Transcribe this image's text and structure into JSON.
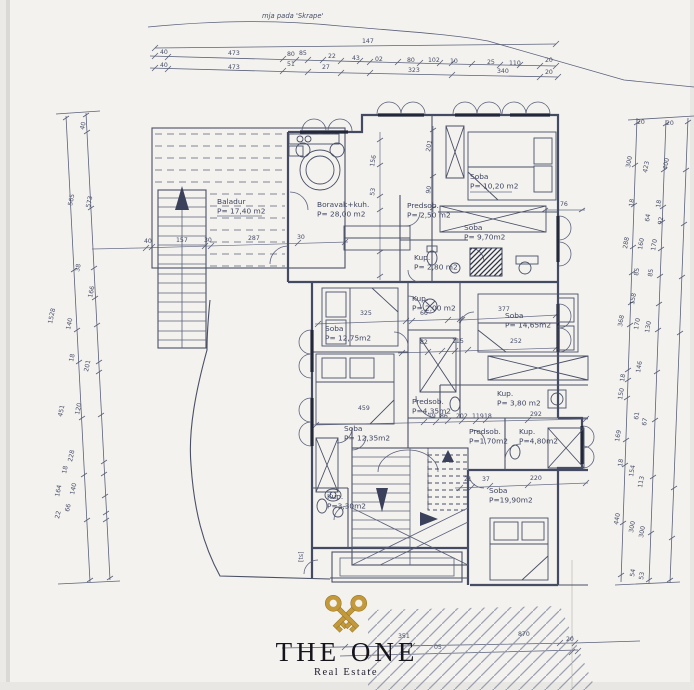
{
  "meta": {
    "paper_color": "#f3f2ef",
    "ink_color": "#454b63",
    "gold_color": "#c3993b",
    "logo_text_color": "#15141b"
  },
  "site": {
    "contour_label": "mja pada 'Skrape'"
  },
  "logo": {
    "title": "THE ONE",
    "subtitle": "Real Estate"
  },
  "rooms": [
    {
      "name": "Baladur",
      "area": "P= 17,40 m2",
      "x": 217,
      "y": 204
    },
    {
      "name": "Boravak+kuh.",
      "area": "P= 28,00 m2",
      "x": 317,
      "y": 207
    },
    {
      "name": "Soba",
      "area": "P= 10,20 m2",
      "x": 470,
      "y": 179
    },
    {
      "name": "Predsob.",
      "area": "P= 2,50 m2",
      "x": 407,
      "y": 208
    },
    {
      "name": "Soba",
      "area": "P= 9,70m2",
      "x": 464,
      "y": 230
    },
    {
      "name": "Kup.",
      "area": "P= 2,80 m2",
      "x": 414,
      "y": 260
    },
    {
      "name": "Soba",
      "area": "P= 12,75m2",
      "x": 325,
      "y": 331
    },
    {
      "name": "Kup.",
      "area": "P= 2,00 m2",
      "x": 412,
      "y": 301
    },
    {
      "name": "Soba",
      "area": "P= 14,65m2",
      "x": 505,
      "y": 318
    },
    {
      "name": "Predsob.",
      "area": "P=4,35m2",
      "x": 412,
      "y": 404
    },
    {
      "name": "Kup.",
      "area": "P= 3,80 m2",
      "x": 497,
      "y": 396
    },
    {
      "name": "Soba",
      "area": "P= 12,35m2",
      "x": 344,
      "y": 431
    },
    {
      "name": "Predsob.",
      "area": "P=1,70m2",
      "x": 469,
      "y": 434
    },
    {
      "name": "Kup.",
      "area": "P=4,80m2",
      "x": 519,
      "y": 434
    },
    {
      "name": "Soba",
      "area": "P=19,90m2",
      "x": 489,
      "y": 493
    },
    {
      "name": "Kup.",
      "area": "P=3,30m2",
      "x": 327,
      "y": 499
    }
  ],
  "dimension_labels": [
    {
      "t": "147",
      "x": 362,
      "y": 43
    },
    {
      "t": "40",
      "x": 160,
      "y": 54
    },
    {
      "t": "473",
      "x": 228,
      "y": 55
    },
    {
      "t": "80",
      "x": 287,
      "y": 56
    },
    {
      "t": "85",
      "x": 299,
      "y": 55
    },
    {
      "t": "22",
      "x": 328,
      "y": 58
    },
    {
      "t": "43",
      "x": 352,
      "y": 60
    },
    {
      "t": "02",
      "x": 375,
      "y": 61
    },
    {
      "t": "80",
      "x": 407,
      "y": 62
    },
    {
      "t": "102",
      "x": 428,
      "y": 62
    },
    {
      "t": "10",
      "x": 450,
      "y": 63
    },
    {
      "t": "25",
      "x": 487,
      "y": 64
    },
    {
      "t": "110",
      "x": 509,
      "y": 65
    },
    {
      "t": "20",
      "x": 545,
      "y": 62
    },
    {
      "t": "40",
      "x": 160,
      "y": 67
    },
    {
      "t": "473",
      "x": 228,
      "y": 69
    },
    {
      "t": "51",
      "x": 287,
      "y": 66
    },
    {
      "t": "27",
      "x": 322,
      "y": 69
    },
    {
      "t": "323",
      "x": 408,
      "y": 72
    },
    {
      "t": "340",
      "x": 497,
      "y": 73
    },
    {
      "t": "20",
      "x": 545,
      "y": 74
    },
    {
      "t": "40",
      "x": 144,
      "y": 243
    },
    {
      "t": "157",
      "x": 176,
      "y": 242
    },
    {
      "t": "30",
      "x": 204,
      "y": 242
    },
    {
      "t": "287",
      "x": 248,
      "y": 240
    },
    {
      "t": "30",
      "x": 297,
      "y": 239
    },
    {
      "t": "156",
      "x": 374,
      "y": 167,
      "r": -80
    },
    {
      "t": "53",
      "x": 374,
      "y": 196,
      "r": -80
    },
    {
      "t": "201",
      "x": 430,
      "y": 152,
      "r": -80
    },
    {
      "t": "90",
      "x": 430,
      "y": 194,
      "r": -80
    },
    {
      "t": "76",
      "x": 560,
      "y": 206
    },
    {
      "t": "325",
      "x": 360,
      "y": 315
    },
    {
      "t": "66",
      "x": 420,
      "y": 315
    },
    {
      "t": "377",
      "x": 498,
      "y": 311
    },
    {
      "t": "82",
      "x": 420,
      "y": 344
    },
    {
      "t": "115",
      "x": 452,
      "y": 343
    },
    {
      "t": "252",
      "x": 510,
      "y": 343
    },
    {
      "t": "459",
      "x": 358,
      "y": 410
    },
    {
      "t": "19",
      "x": 428,
      "y": 418
    },
    {
      "t": "86",
      "x": 440,
      "y": 418
    },
    {
      "t": "202",
      "x": 456,
      "y": 418
    },
    {
      "t": "119",
      "x": 472,
      "y": 418
    },
    {
      "t": "18",
      "x": 484,
      "y": 418
    },
    {
      "t": "292",
      "x": 530,
      "y": 416
    },
    {
      "t": "21",
      "x": 464,
      "y": 481
    },
    {
      "t": "37",
      "x": 482,
      "y": 481
    },
    {
      "t": "220",
      "x": 530,
      "y": 480
    },
    {
      "t": "40",
      "x": 84,
      "y": 130,
      "r": -78
    },
    {
      "t": "565",
      "x": 72,
      "y": 206,
      "r": -78
    },
    {
      "t": "573",
      "x": 90,
      "y": 208,
      "r": -78
    },
    {
      "t": "38",
      "x": 79,
      "y": 272,
      "r": -78
    },
    {
      "t": "166",
      "x": 92,
      "y": 298,
      "r": -78
    },
    {
      "t": "1528",
      "x": 52,
      "y": 324,
      "r": -78
    },
    {
      "t": "140",
      "x": 70,
      "y": 330,
      "r": -78
    },
    {
      "t": "18",
      "x": 73,
      "y": 362,
      "r": -78
    },
    {
      "t": "201",
      "x": 88,
      "y": 372,
      "r": -78
    },
    {
      "t": "451",
      "x": 62,
      "y": 417,
      "r": -78
    },
    {
      "t": "120",
      "x": 79,
      "y": 415,
      "r": -78
    },
    {
      "t": "228",
      "x": 72,
      "y": 462,
      "r": -78
    },
    {
      "t": "18",
      "x": 66,
      "y": 474,
      "r": -78
    },
    {
      "t": "164",
      "x": 59,
      "y": 497,
      "r": -78
    },
    {
      "t": "140",
      "x": 74,
      "y": 495,
      "r": -78
    },
    {
      "t": "66",
      "x": 69,
      "y": 512,
      "r": -78
    },
    {
      "t": "22",
      "x": 59,
      "y": 519,
      "r": -78
    },
    {
      "t": "20",
      "x": 637,
      "y": 124
    },
    {
      "t": "20",
      "x": 666,
      "y": 125
    },
    {
      "t": "300",
      "x": 630,
      "y": 168,
      "r": -80
    },
    {
      "t": "423",
      "x": 647,
      "y": 173,
      "r": -80
    },
    {
      "t": "400",
      "x": 667,
      "y": 170,
      "r": -80
    },
    {
      "t": "18",
      "x": 633,
      "y": 207,
      "r": -80
    },
    {
      "t": "18",
      "x": 660,
      "y": 208,
      "r": -80
    },
    {
      "t": "64",
      "x": 649,
      "y": 222,
      "r": -80
    },
    {
      "t": "92",
      "x": 662,
      "y": 225,
      "r": -80
    },
    {
      "t": "288",
      "x": 627,
      "y": 249,
      "r": -80
    },
    {
      "t": "160",
      "x": 642,
      "y": 250,
      "r": -80
    },
    {
      "t": "170",
      "x": 655,
      "y": 251,
      "r": -80
    },
    {
      "t": "85",
      "x": 638,
      "y": 276,
      "r": -80
    },
    {
      "t": "85",
      "x": 652,
      "y": 277,
      "r": -80
    },
    {
      "t": "158",
      "x": 634,
      "y": 305,
      "r": -80
    },
    {
      "t": "368",
      "x": 622,
      "y": 327,
      "r": -80
    },
    {
      "t": "170",
      "x": 638,
      "y": 330,
      "r": -80
    },
    {
      "t": "130",
      "x": 649,
      "y": 333,
      "r": -80
    },
    {
      "t": "146",
      "x": 640,
      "y": 373,
      "r": -80
    },
    {
      "t": "18",
      "x": 624,
      "y": 382,
      "r": -80
    },
    {
      "t": "150",
      "x": 622,
      "y": 400,
      "r": -80
    },
    {
      "t": "61",
      "x": 638,
      "y": 420,
      "r": -80
    },
    {
      "t": "67",
      "x": 646,
      "y": 426,
      "r": -80
    },
    {
      "t": "169",
      "x": 619,
      "y": 442,
      "r": -80
    },
    {
      "t": "18",
      "x": 622,
      "y": 467,
      "r": -80
    },
    {
      "t": "154",
      "x": 633,
      "y": 477,
      "r": -80
    },
    {
      "t": "113",
      "x": 642,
      "y": 488,
      "r": -80
    },
    {
      "t": "440",
      "x": 618,
      "y": 525,
      "r": -80
    },
    {
      "t": "300",
      "x": 633,
      "y": 533,
      "r": -80
    },
    {
      "t": "300",
      "x": 643,
      "y": 538,
      "r": -80
    },
    {
      "t": "54",
      "x": 634,
      "y": 577,
      "r": -80
    },
    {
      "t": "53",
      "x": 643,
      "y": 580,
      "r": -80
    },
    {
      "t": "351",
      "x": 398,
      "y": 638
    },
    {
      "t": "05",
      "x": 434,
      "y": 649
    },
    {
      "t": "870",
      "x": 518,
      "y": 636
    },
    {
      "t": "20",
      "x": 566,
      "y": 641
    },
    {
      "t": "[ts]",
      "x": 303,
      "y": 562,
      "r": -90
    }
  ]
}
